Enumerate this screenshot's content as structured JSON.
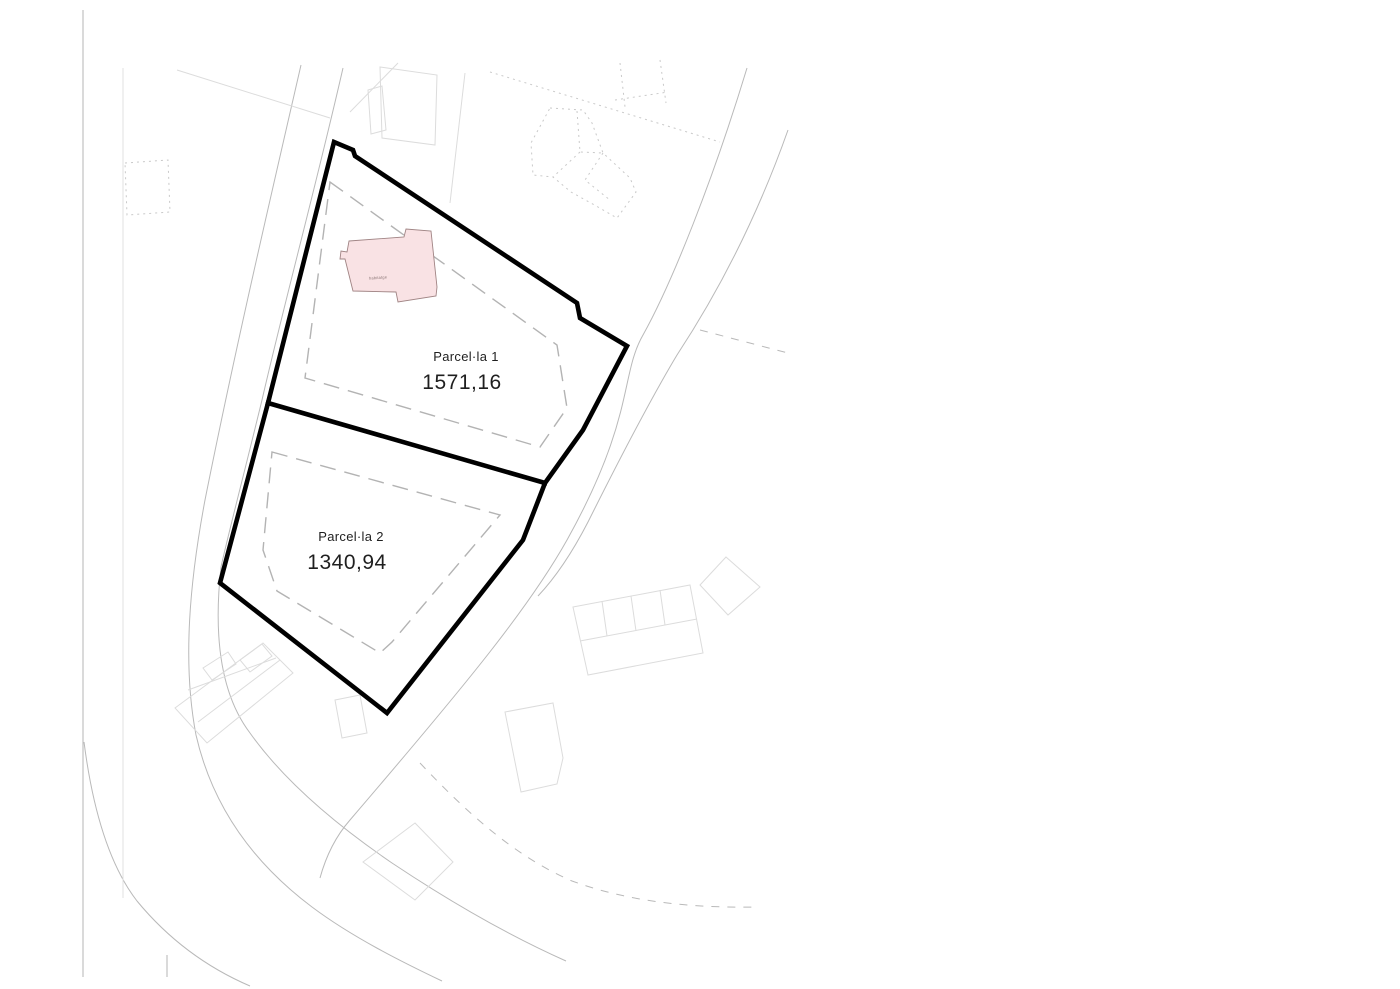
{
  "plan": {
    "parcel1": {
      "label": "Parcel·la 1",
      "area": "1571,16"
    },
    "parcel2": {
      "label": "Parcel·la 2",
      "area": "1340,94"
    },
    "building": {
      "label": "habitatge"
    }
  },
  "colors": {
    "boundary": "#000000",
    "building_fill": "#f9e2e4",
    "building_stroke": "#a08484",
    "setback": "#b3b3b3",
    "road": "#b9b9b9",
    "context": "#dcdcdc",
    "dotted": "#c9c9c9",
    "sheet": "#b5b5b5",
    "text": "#1f1f1f"
  }
}
